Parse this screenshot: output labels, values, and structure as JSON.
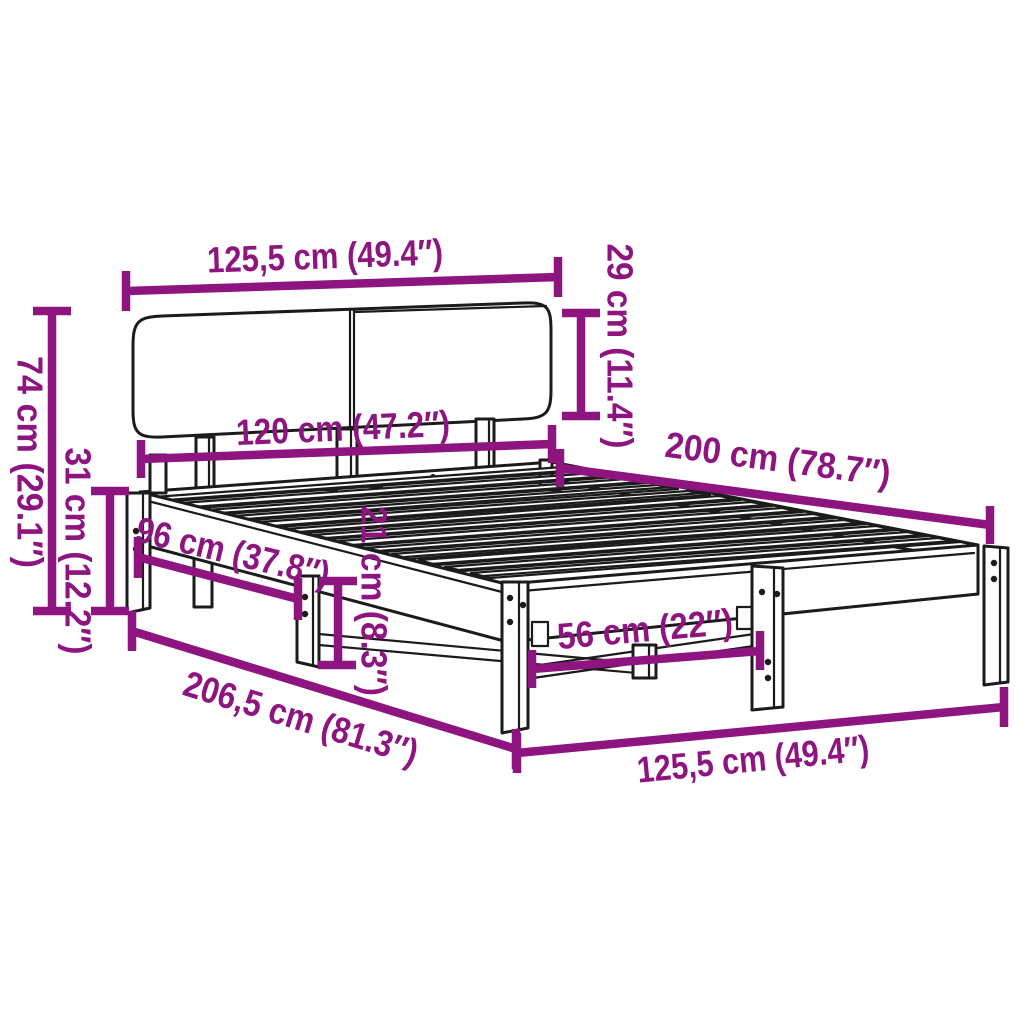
{
  "diagram": {
    "type": "product-dimension-diagram",
    "subject": "bed-frame-with-headboard",
    "colors": {
      "dimension_accent": "#8E1480",
      "drawing_line": "#1b1b1b",
      "background": "#ffffff"
    },
    "labels": {
      "headboard_width": "125,5 cm (49.4″)",
      "headboard_height": "29 cm (11.4″)",
      "slat_area_width": "120 cm (47.2″)",
      "bed_length": "200 cm (78.7″)",
      "overall_height": "74 cm (29.1″)",
      "frame_side_height": "31 cm (12.2″)",
      "side_leg_spacing": "96 cm (37.8″)",
      "under_bed_clearance": "21 cm (8.3″)",
      "foot_leg_spacing": "56 cm (22″)",
      "overall_length": "206,5 cm (81.3″)",
      "frame_width": "125,5 cm (49.4″)"
    }
  }
}
